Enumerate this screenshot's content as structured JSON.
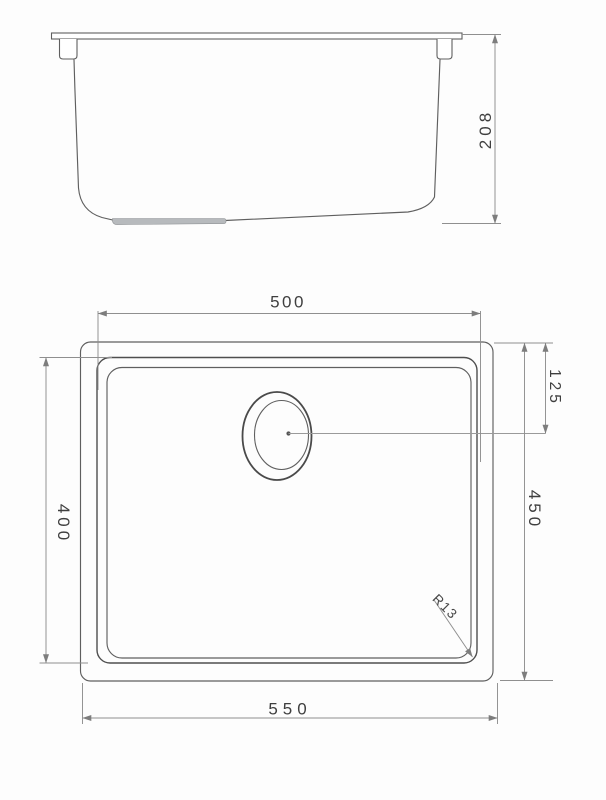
{
  "drawing": {
    "dimensions": {
      "side_height": "208",
      "bowl_width": "500",
      "bowl_depth": "400",
      "overall_depth": "450",
      "drain_from_top": "125",
      "overall_width": "550",
      "corner_radius": "R13"
    }
  }
}
